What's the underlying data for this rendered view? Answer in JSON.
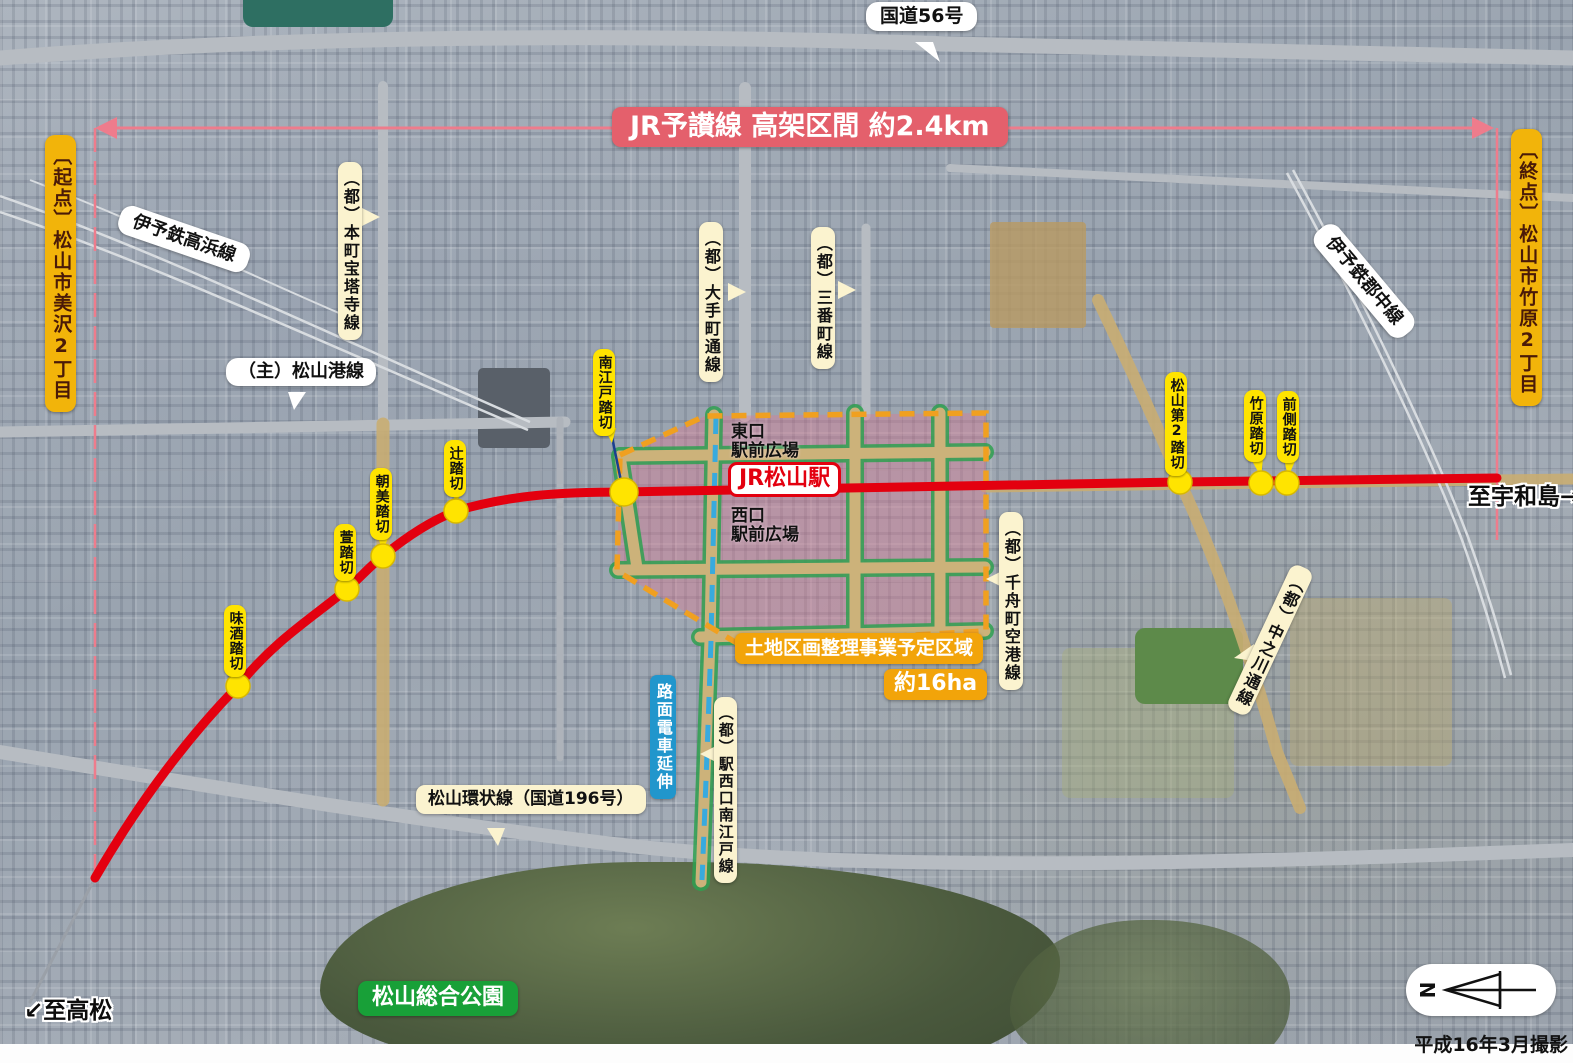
{
  "banner": {
    "text": "JR予讃線 高架区間 約2.4km"
  },
  "endpoints": {
    "start": "〔起点〕松山市美沢2丁目",
    "end": "〔終点〕松山市竹原2丁目"
  },
  "station": {
    "name": "JR松山駅",
    "east_plaza": "東口\n駅前広場",
    "west_plaza": "西口\n駅前広場"
  },
  "project": {
    "title": "土地区画整理事業予定区域",
    "area": "約16ha",
    "tram_extension": "路面電車延伸"
  },
  "crossings": [
    {
      "name": "南江戸踏切"
    },
    {
      "name": "辻踏切"
    },
    {
      "name": "朝美踏切"
    },
    {
      "name": "萱踏切"
    },
    {
      "name": "味酒踏切"
    },
    {
      "name": "松山第2踏切"
    },
    {
      "name": "竹原踏切"
    },
    {
      "name": "前側踏切"
    }
  ],
  "railways": [
    {
      "name": "伊予鉄高浜線"
    },
    {
      "name": "伊予鉄郡中線"
    }
  ],
  "roads": [
    {
      "name": "国道56号"
    },
    {
      "name": "（都）本町宝塔寺線"
    },
    {
      "name": "（都）大手町通線"
    },
    {
      "name": "（都）三番町線"
    },
    {
      "name": "（主）松山港線"
    },
    {
      "name": "（都）千舟町空港線"
    },
    {
      "name": "（都）駅西口南江戸線"
    },
    {
      "name": "（都）中之川通線"
    },
    {
      "name": "松山環状線（国道196号）"
    }
  ],
  "directions": {
    "to_takamatsu": "↙至高松",
    "to_uwajima": "至宇和島→"
  },
  "park": {
    "name": "松山総合公園"
  },
  "compass": {
    "north": "N"
  },
  "credit": {
    "text": "平成16年3月撮影"
  },
  "colors": {
    "jr_line": "#e3000f",
    "dimension_line": "#ee7c8c",
    "crossing_marker": "#ffe400",
    "project_boundary": "#f0a020",
    "project_fill": "#e17d96",
    "planned_road_green": "#2fa050",
    "tram_blue": "#38aade",
    "endpoint_label_bg": "#f2b40a",
    "banner_bg": "#e4606c"
  }
}
